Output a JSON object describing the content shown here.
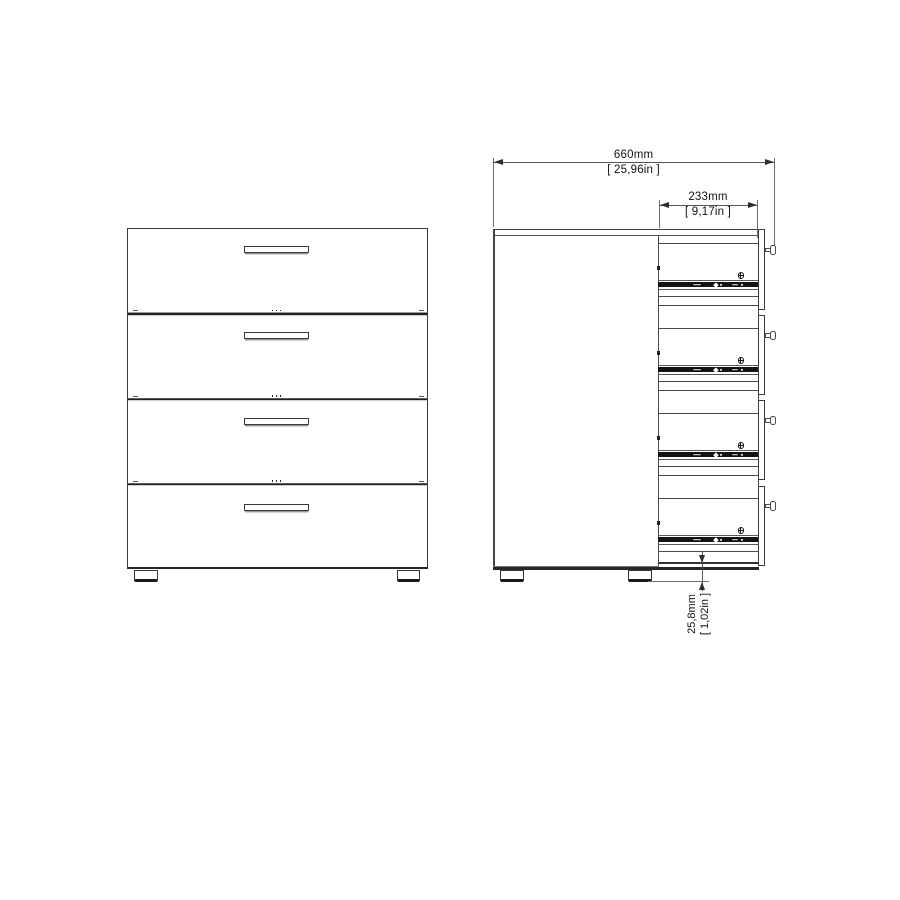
{
  "dimensions": {
    "overall_width": {
      "mm": "660mm",
      "inches": "[ 25,96in ]"
    },
    "drawer_depth": {
      "mm": "233mm",
      "inches": "[ 9,17in ]"
    },
    "foot_height": {
      "mm": "25,8mm",
      "inches": "[ 1,02in ]"
    }
  },
  "views": {
    "front": {
      "drawers": 4,
      "handles": 4,
      "feet": 2
    },
    "side": {
      "drawer_compartments": 4,
      "slide_rails": 4,
      "screws": 4,
      "feet": 2
    }
  },
  "colors": {
    "background": "#ffffff",
    "line": "#3c3c3c",
    "rail_band": "#141414",
    "text": "#121212"
  }
}
